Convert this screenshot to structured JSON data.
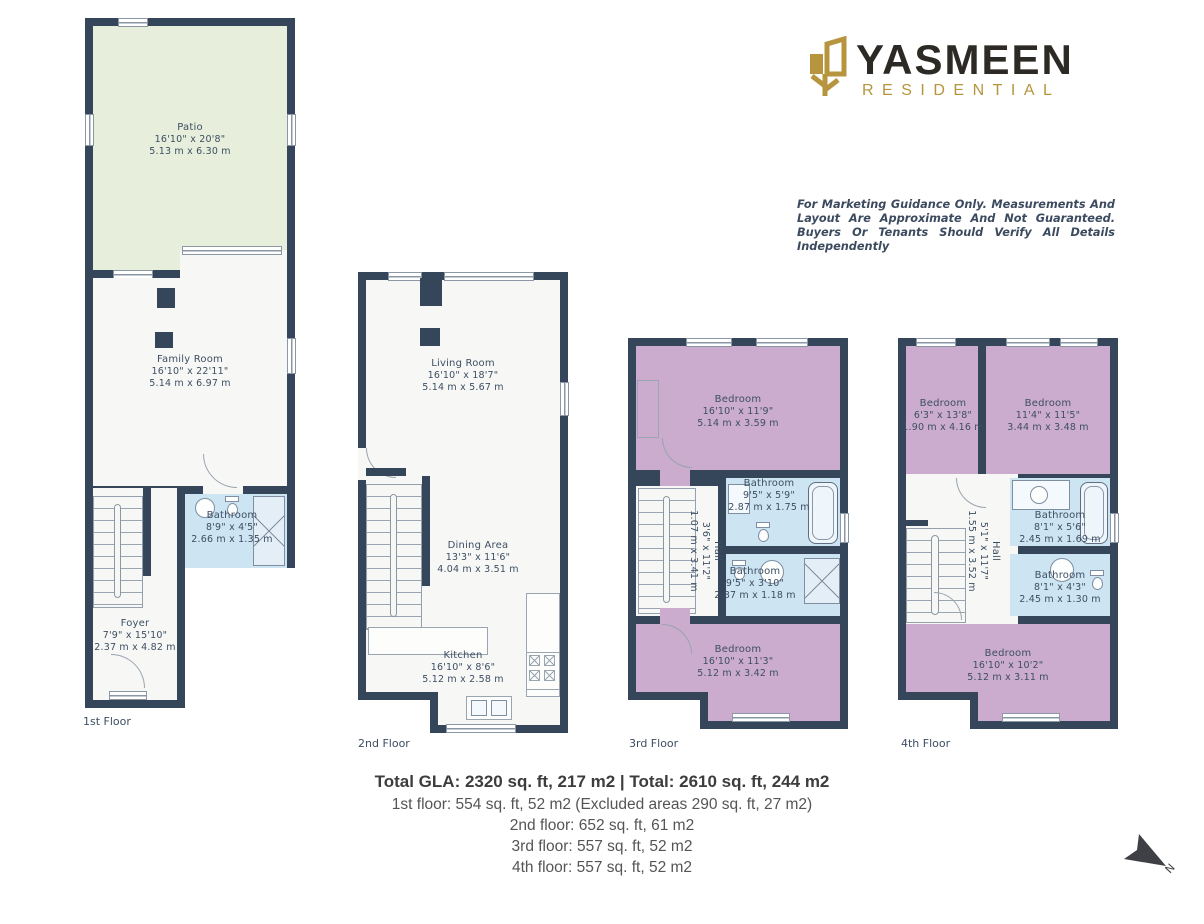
{
  "brand": {
    "name": "YASMEEN",
    "tagline": "RESIDENTIAL"
  },
  "disclaimer": "For Marketing Guidance Only. Measurements And Layout Are Approximate And Not Guaranteed. Buyers Or Tenants Should Verify All Details Independently",
  "north_label": "N",
  "floors": {
    "floor1": {
      "label": "1st Floor",
      "patio": {
        "name": "Patio",
        "imperial": "16'10\" x 20'8\"",
        "metric": "5.13 m x 6.30 m"
      },
      "family": {
        "name": "Family Room",
        "imperial": "16'10\" x 22'11\"",
        "metric": "5.14 m x 6.97 m"
      },
      "bathroom": {
        "name": "Bathroom",
        "imperial": "8'9\" x 4'5\"",
        "metric": "2.66 m x 1.35 m"
      },
      "foyer": {
        "name": "Foyer",
        "imperial": "7'9\" x 15'10\"",
        "metric": "2.37 m x 4.82 m"
      }
    },
    "floor2": {
      "label": "2nd Floor",
      "living": {
        "name": "Living Room",
        "imperial": "16'10\" x 18'7\"",
        "metric": "5.14 m x 5.67 m"
      },
      "dining": {
        "name": "Dining Area",
        "imperial": "13'3\" x 11'6\"",
        "metric": "4.04 m x 3.51 m"
      },
      "kitchen": {
        "name": "Kitchen",
        "imperial": "16'10\" x 8'6\"",
        "metric": "5.12 m x 2.58 m"
      }
    },
    "floor3": {
      "label": "3rd Floor",
      "bedroom_top": {
        "name": "Bedroom",
        "imperial": "16'10\" x 11'9\"",
        "metric": "5.14 m x 3.59 m"
      },
      "bathroom_top": {
        "name": "Bathroom",
        "imperial": "9'5\" x 5'9\"",
        "metric": "2.87 m x 1.75 m"
      },
      "bathroom_mid": {
        "name": "Bathroom",
        "imperial": "9'5\" x 3'10\"",
        "metric": "2.87 m x 1.18 m"
      },
      "hall": {
        "name": "Hall",
        "imperial": "3'6\" x 11'2\"",
        "metric": "1.07 m x 3.41 m"
      },
      "bedroom_bottom": {
        "name": "Bedroom",
        "imperial": "16'10\" x 11'3\"",
        "metric": "5.12 m x 3.42 m"
      }
    },
    "floor4": {
      "label": "4th Floor",
      "bedroom_left": {
        "name": "Bedroom",
        "imperial": "6'3\" x 13'8\"",
        "metric": "1.90 m x 4.16 m"
      },
      "bedroom_right": {
        "name": "Bedroom",
        "imperial": "11'4\" x 11'5\"",
        "metric": "3.44 m x 3.48 m"
      },
      "bathroom_top": {
        "name": "Bathroom",
        "imperial": "8'1\" x 5'6\"",
        "metric": "2.45 m x 1.69 m"
      },
      "bathroom_mid": {
        "name": "Bathroom",
        "imperial": "8'1\" x 4'3\"",
        "metric": "2.45 m x 1.30 m"
      },
      "hall": {
        "name": "Hall",
        "imperial": "5'1\" x 11'7\"",
        "metric": "1.55 m x 3.52 m"
      },
      "bedroom_bottom": {
        "name": "Bedroom",
        "imperial": "16'10\" x 10'2\"",
        "metric": "5.12 m x 3.11 m"
      }
    }
  },
  "summary": {
    "total": "Total GLA: 2320 sq. ft, 217 m2 | Total: 2610 sq. ft, 244 m2",
    "lines": [
      "1st floor: 554 sq. ft, 52 m2 (Excluded areas 290 sq. ft, 27 m2)",
      "2nd floor: 652 sq. ft, 61 m2",
      "3rd floor: 557 sq. ft, 52 m2",
      "4th floor: 557 sq. ft, 52 m2"
    ]
  },
  "colors": {
    "wall": "#36465a",
    "patio": "#e7efdc",
    "floor": "#f7f8f6",
    "bathroom": "#cde4f2",
    "bedroom": "#cbaccf",
    "gold": "#b6953e",
    "brand_dark": "#2d2a25",
    "label_text": "#3d4e63"
  }
}
